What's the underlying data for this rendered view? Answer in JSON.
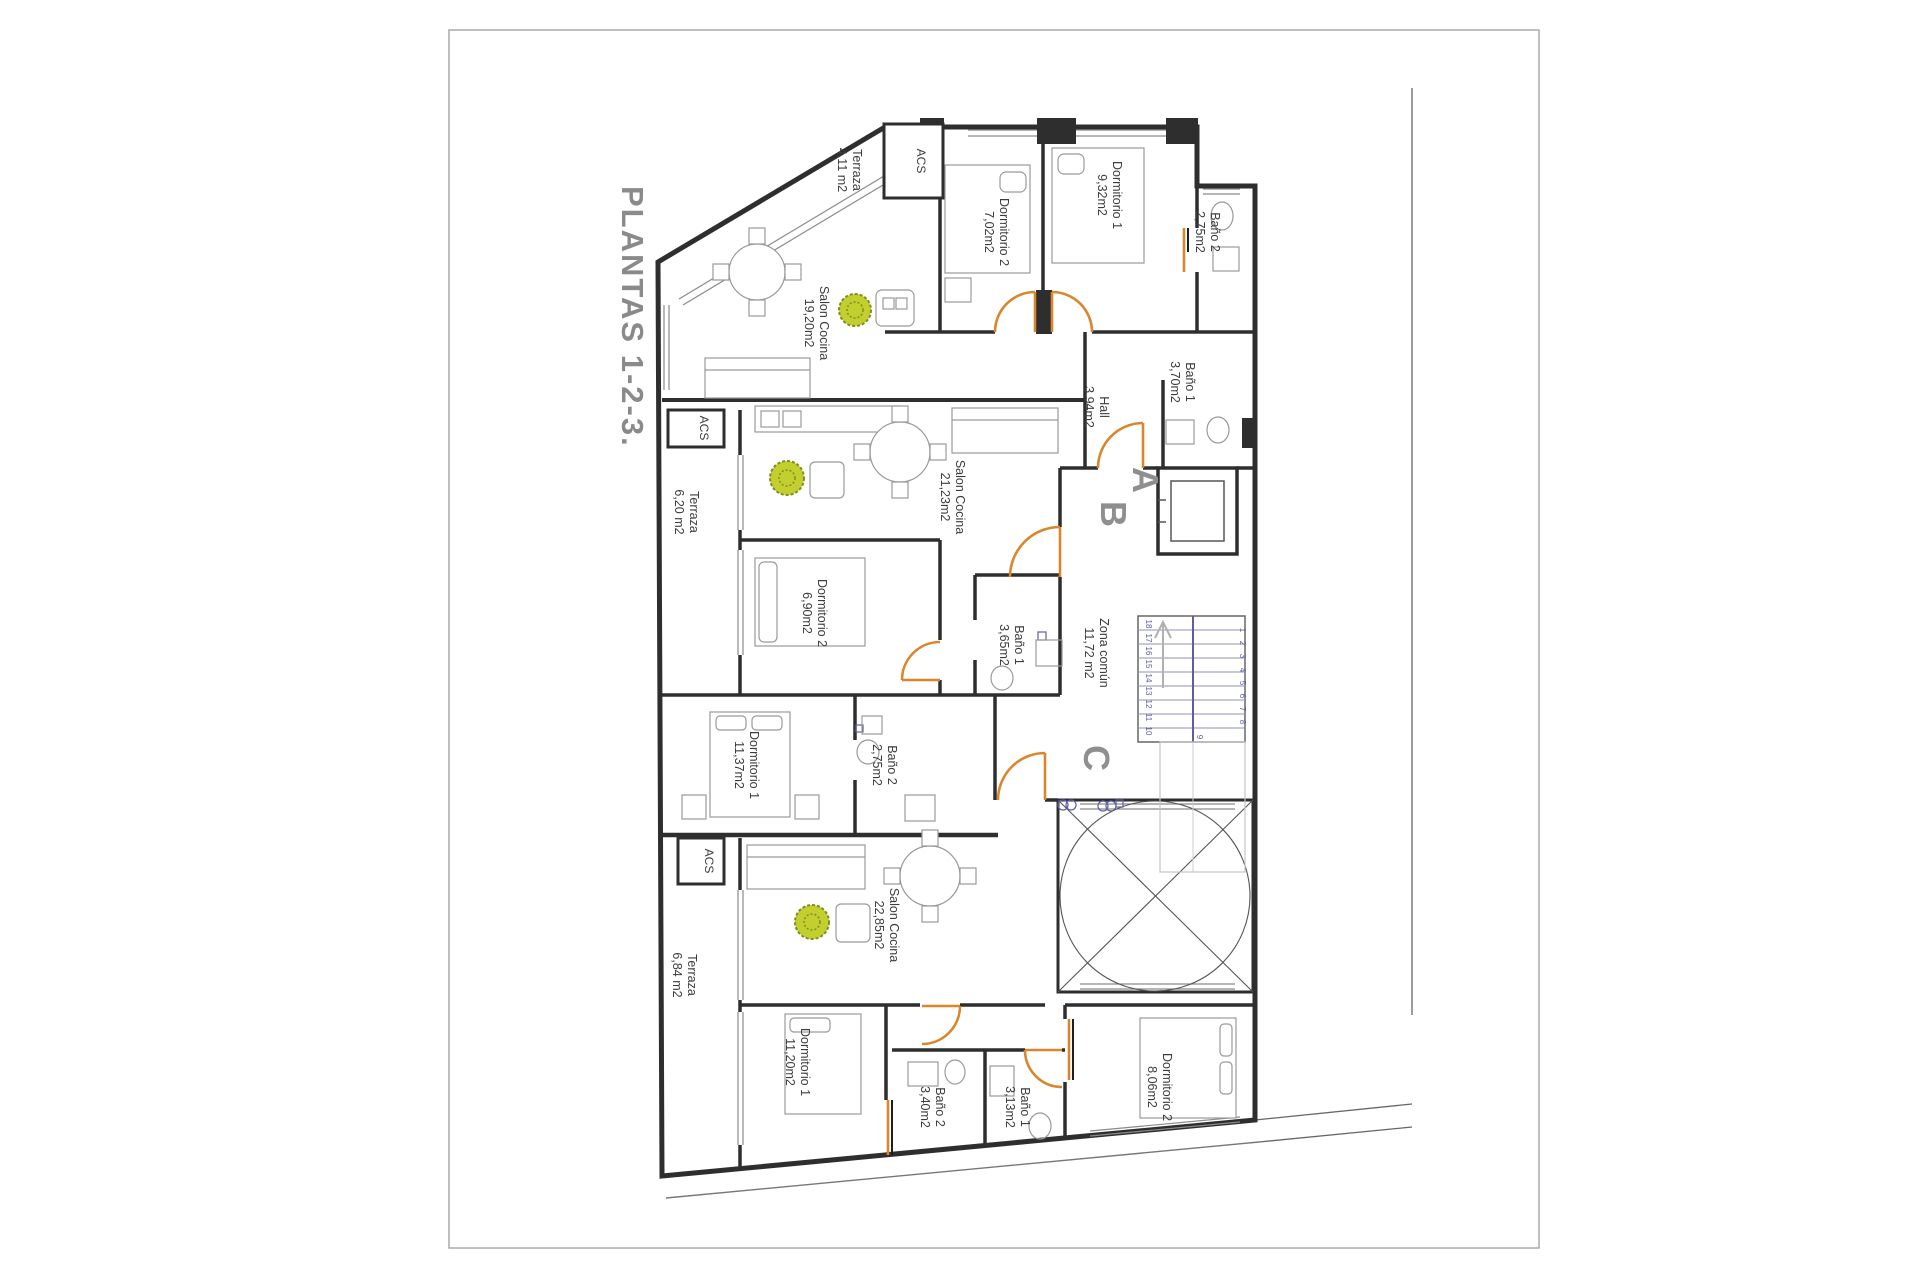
{
  "page": {
    "title": "PLANTAS 1-2-3."
  },
  "colors": {
    "wall": "#2e2e2e",
    "door_orange": "#d9862c",
    "stair_blue": "#5d5da6",
    "plant_green": "#b9c832",
    "title_gray": "#8a8a8a"
  },
  "labels": {
    "acs": "ACS"
  },
  "apartment_letters": {
    "a": "A",
    "b": "B",
    "c": "C"
  },
  "rooms": {
    "terraza_top": {
      "name": "Terraza",
      "area": "4,11 m2"
    },
    "dorm2_top": {
      "name": "Dormitorio 2",
      "area": "7,02m2"
    },
    "dorm1_top": {
      "name": "Dormitorio 1",
      "area": "9,32m2"
    },
    "bano2_top": {
      "name": "Baño 2",
      "area": "2,75m2"
    },
    "salon_top": {
      "name": "Salon Cocina",
      "area": "19,20m2"
    },
    "hall": {
      "name": "Hall",
      "area": "3,94m2"
    },
    "bano1_top": {
      "name": "Baño 1",
      "area": "3,70m2"
    },
    "terraza_mid": {
      "name": "Terraza",
      "area": "6,20 m2"
    },
    "salon_mid": {
      "name": "Salon Cocina",
      "area": "21,23m2"
    },
    "dorm2_mid": {
      "name": "Dormitorio 2",
      "area": "6,90m2"
    },
    "bano1_mid": {
      "name": "Baño 1",
      "area": "3,65m2"
    },
    "zona_comun": {
      "name": "Zona común",
      "area": "11,72 m2"
    },
    "dorm1_mid": {
      "name": "Dormitorio 1",
      "area": "11,37m2"
    },
    "bano2_mid": {
      "name": "Baño 2",
      "area": "2,75m2"
    },
    "terraza_bot": {
      "name": "Terraza",
      "area": "6,84 m2"
    },
    "salon_bot": {
      "name": "Salon Cocina",
      "area": "22,85m2"
    },
    "dorm1_bot": {
      "name": "Dormitorio 1",
      "area": "11,20m2"
    },
    "bano2_bot": {
      "name": "Baño 2",
      "area": "3,40m2"
    },
    "bano1_bot": {
      "name": "Baño 1",
      "area": "3,13m2"
    },
    "dorm2_bot": {
      "name": "Dormitorio 2",
      "area": "8,06m2"
    }
  },
  "stairs": {
    "left": [
      "18",
      "17",
      "16",
      "15",
      "14",
      "13",
      "12",
      "11",
      "10"
    ],
    "right": [
      "1",
      "2",
      "3",
      "4",
      "5",
      "6",
      "7",
      "8"
    ],
    "mid": "9"
  }
}
